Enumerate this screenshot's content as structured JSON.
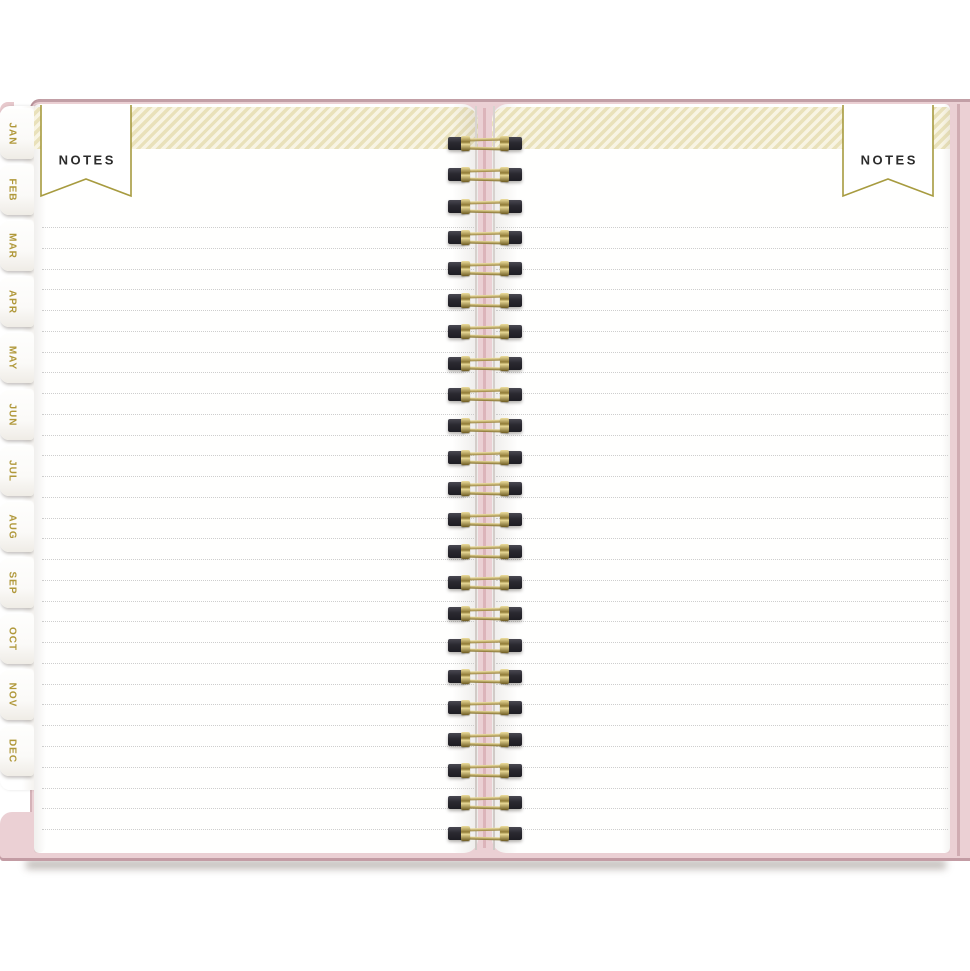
{
  "banners": {
    "left_label": "NOTES",
    "right_label": "NOTES"
  },
  "tabs": {
    "months": [
      "JAN",
      "FEB",
      "MAR",
      "APR",
      "MAY",
      "JUN",
      "JUL",
      "AUG",
      "SEP",
      "OCT",
      "NOV",
      "DEC"
    ]
  },
  "ruling": {
    "line_count": 30
  },
  "binding": {
    "loop_count": 23
  },
  "colors": {
    "cover_pink": "#ebd0d4",
    "cover_edge_pink": "#bb939b",
    "banner_border_gold": "#a79b3f",
    "tab_text_gold": "#b0983a",
    "stripe_cream": "#e9e1ba",
    "stripe_light": "#f8f4e3",
    "label_text": "#2c2c2c",
    "wire_gold": "#a98f46",
    "wire_hole_dark": "#26252c",
    "ruled_line_gray": "#c6c6c6"
  }
}
